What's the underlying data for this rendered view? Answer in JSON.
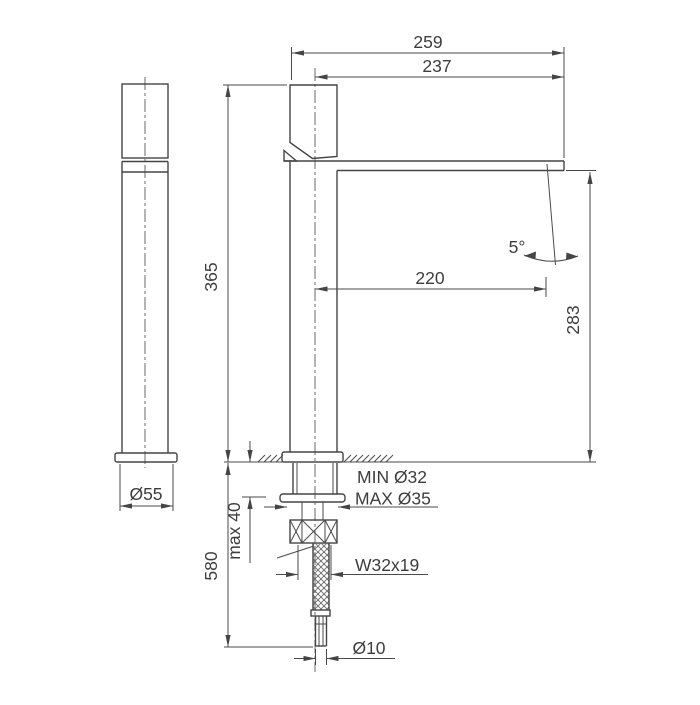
{
  "drawing": {
    "labels": {
      "width_overall": "259",
      "spout_to_tip": "237",
      "body_height": "365",
      "spout_reach": "220",
      "spout_angle": "5°",
      "spout_clearance": "283",
      "base_diameter": "Ø55",
      "hole_min": "MIN Ø32",
      "hole_max": "MAX Ø35",
      "deck_thickness": "max 40",
      "hose_length": "580",
      "thread_spec": "W32x19",
      "hose_diameter": "Ø10"
    },
    "colors": {
      "line": "#454545",
      "text": "#3d3d3d",
      "background": "#ffffff"
    }
  }
}
